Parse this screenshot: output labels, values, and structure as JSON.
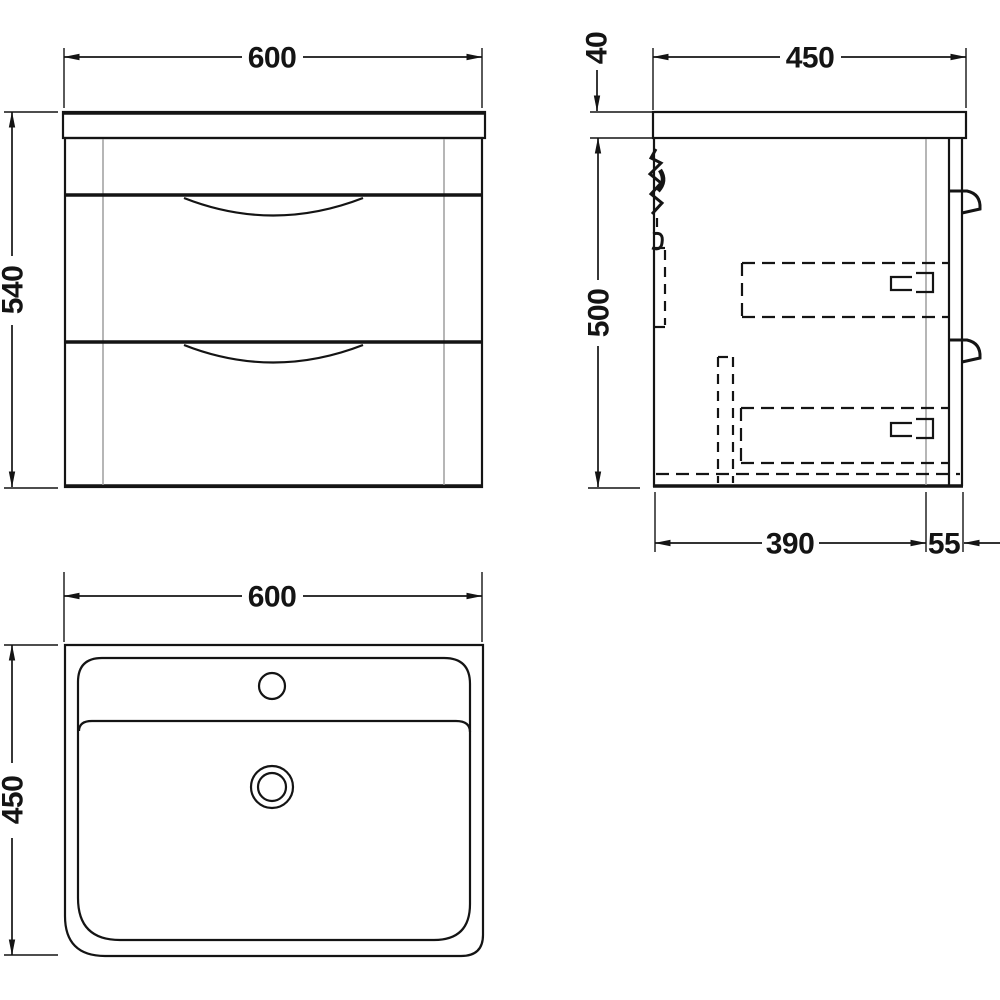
{
  "drawing": {
    "title": "Wall-hung two-drawer vanity unit with basin — dimensioned technical drawing",
    "units": "mm"
  },
  "colors": {
    "line": "#141414",
    "gray": "#9e9e9e",
    "bg": "#ffffff"
  },
  "dims": {
    "front_width": "600",
    "front_height": "540",
    "side_top_thickness": "40",
    "side_depth": "450",
    "side_carcass_height": "500",
    "side_bottom_depth": "390",
    "side_front_offset": "55",
    "plan_width": "600",
    "plan_depth": "450"
  },
  "views": {
    "front": {
      "name": "front-elevation"
    },
    "side": {
      "name": "side-section"
    },
    "plan": {
      "name": "basin-plan"
    }
  }
}
